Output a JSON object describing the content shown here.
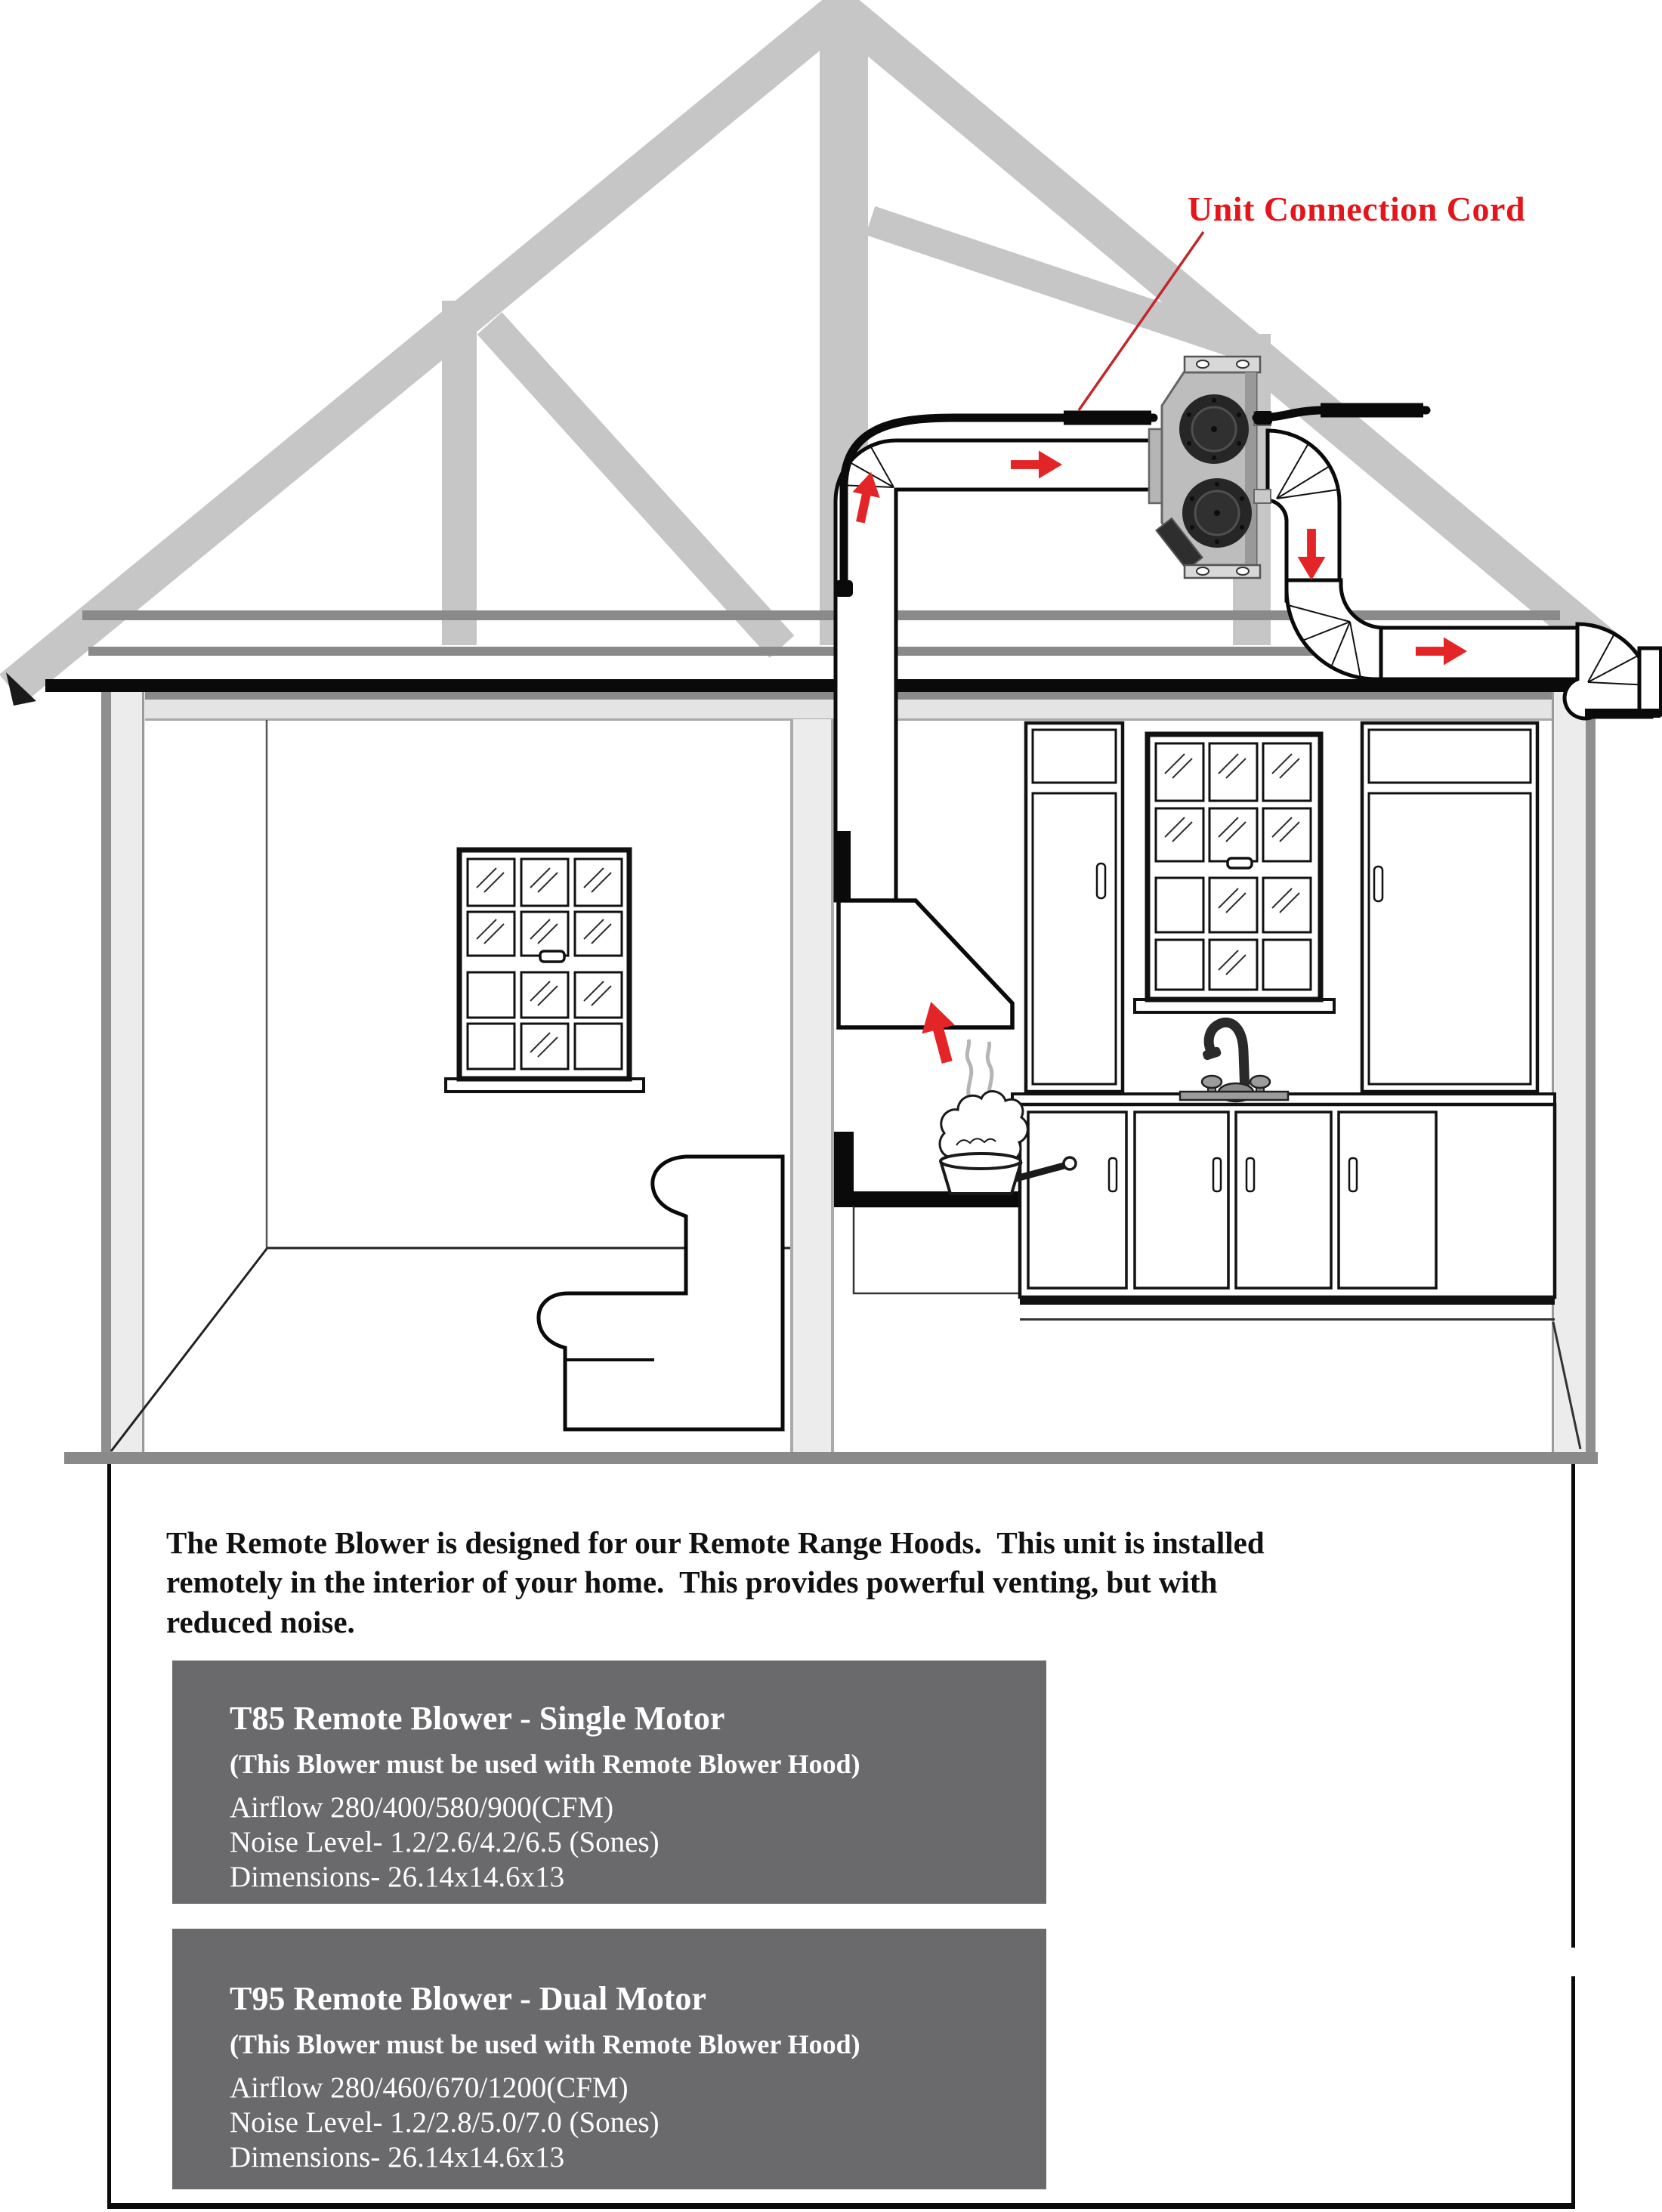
{
  "annotation": {
    "label": "Unit Connection Cord"
  },
  "description": "The Remote Blower is designed for our Remote Range Hoods.  This unit is installed\nremotely in the interior of your home.  This provides powerful venting, but with\nreduced noise.",
  "products": [
    {
      "title": "T85 Remote Blower - Single Motor",
      "note": "(This Blower must be used with Remote Blower Hood)",
      "airflow": "Airflow 280/400/580/900(CFM)",
      "noise_level": "Noise Level- 1.2/2.6/4.2/6.5 (Sones)",
      "dimensions": "Dimensions- 26.14x14.6x13"
    },
    {
      "title": "T95 Remote Blower - Dual Motor",
      "note": "(This Blower must be used with Remote Blower Hood)",
      "airflow": "Airflow 280/460/670/1200(CFM)",
      "noise_level": "Noise Level- 1.2/2.8/5.0/7.0 (Sones)",
      "dimensions": "Dimensions- 26.14x14.6x13"
    }
  ],
  "diagram": {
    "scene": "cutaway house with attic remote blower, ductwork, kitchen range hood and living room",
    "airflow_arrows": [
      "up-into-hood",
      "up-attic-duct",
      "right-to-blower",
      "down-from-blower",
      "right-through-eave"
    ],
    "colors": {
      "arrow_red": "#e42528",
      "label_red": "#e4151b",
      "leader_red": "#c2272b",
      "truss_gray": "#c6c6c6",
      "eave_gray": "#8a8a8a",
      "panel_gray": "#6a696b"
    }
  }
}
